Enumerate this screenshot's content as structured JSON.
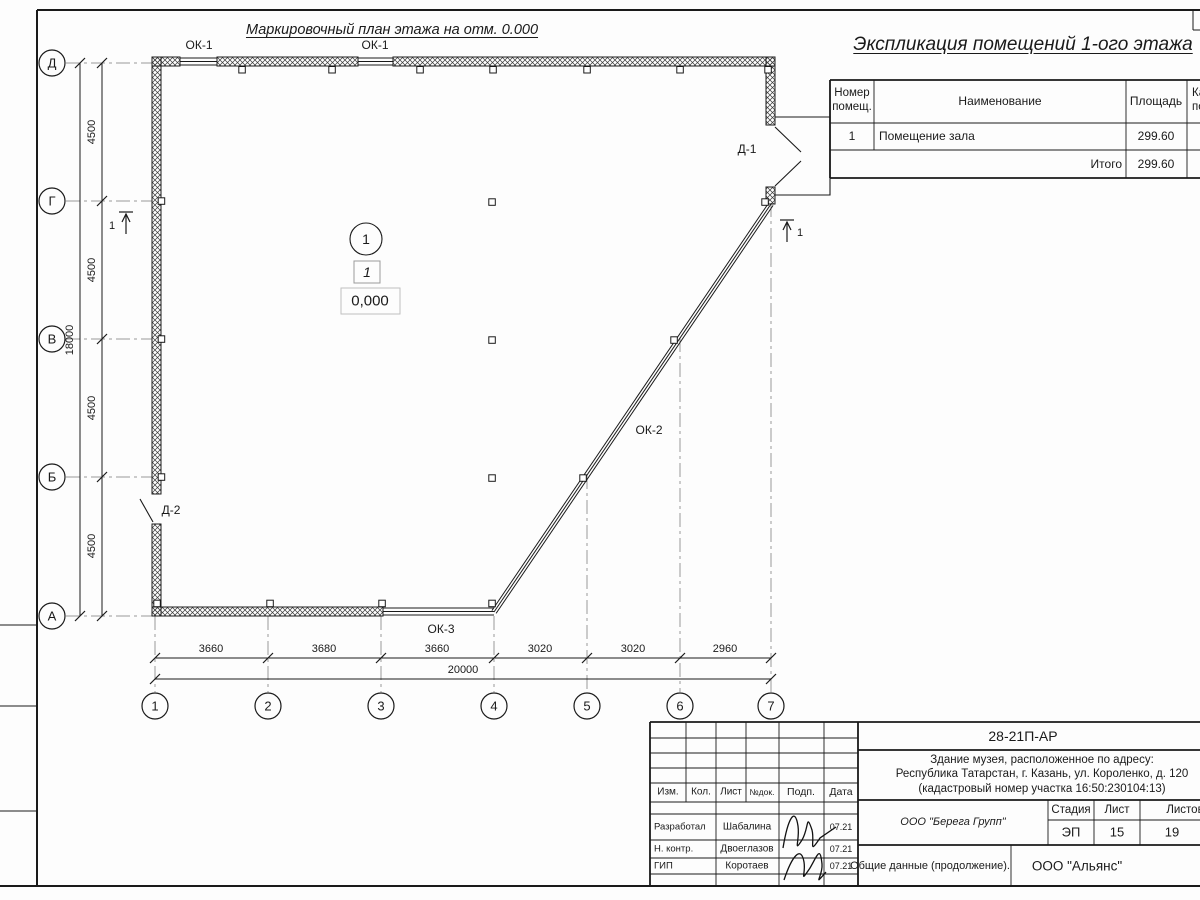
{
  "sheet": {
    "plan_title": "Маркировочный план этажа на отм. 0.000"
  },
  "plan": {
    "axis_rows": [
      "Д",
      "Г",
      "В",
      "Б",
      "А"
    ],
    "axis_cols": [
      "1",
      "2",
      "3",
      "4",
      "5",
      "6",
      "7"
    ],
    "dim_left": [
      "4500",
      "4500",
      "4500",
      "4500"
    ],
    "dim_left_total": "18000",
    "dim_bottom": [
      "3660",
      "3680",
      "3660",
      "3020",
      "3020",
      "2960"
    ],
    "dim_bottom_total": "20000",
    "window_labels": {
      "ok1a": "ОК-1",
      "ok1b": "ОК-1",
      "ok2": "ОК-2",
      "ok3": "ОК-3"
    },
    "door_labels": {
      "d1": "Д-1",
      "d2": "Д-2"
    },
    "section_label_left": "1",
    "section_label_right": "1",
    "room_marker": {
      "axis_circle": "1",
      "room_box": "1",
      "elevation": "0,000"
    }
  },
  "explication": {
    "title": "Экспликация помещений 1-ого этажа",
    "col_num": "Номер\nпомещ.",
    "col_name": "Наименование",
    "col_area": "Площадь",
    "col_cat": "Кат.\nпом.",
    "rows": [
      {
        "num": "1",
        "name": "Помещение зала",
        "area": "299.60"
      }
    ],
    "total_label": "Итого",
    "total_area": "299.60"
  },
  "title_block": {
    "doc_code": "28-21П-АР",
    "object_line1": "Здание музея, расположенное по адресу:",
    "object_line2": "Республика Татарстан, г. Казань, ул. Короленко, д. 120",
    "object_line3": "(кадастровый номер участка 16:50:230104:13)",
    "col_izm": "Изм.",
    "col_kol": "Кол.",
    "col_list": "Лист",
    "col_ndoc": "№док.",
    "col_podp": "Подп.",
    "col_data": "Дата",
    "staff": [
      {
        "role": "Разработал",
        "name": "Шабалина",
        "date": "07.21"
      },
      {
        "role": "Н. контр.",
        "name": "Двоеглазов",
        "date": "07.21"
      },
      {
        "role": "ГИП",
        "name": "Коротаев",
        "date": "07.21"
      }
    ],
    "design_company": "ООО \"Берега Групп\"",
    "stage_label": "Стадия",
    "sheet_label": "Лист",
    "sheets_label": "Листов",
    "stage_value": "ЭП",
    "sheet_value": "15",
    "sheets_value": "19",
    "doc_title": "Общие данные (продолжение).",
    "contractor": "ООО \"Альянс\""
  },
  "colors": {
    "line": "#1a1a1a",
    "axis_line": "#999999",
    "background": "#fdfdfd"
  }
}
